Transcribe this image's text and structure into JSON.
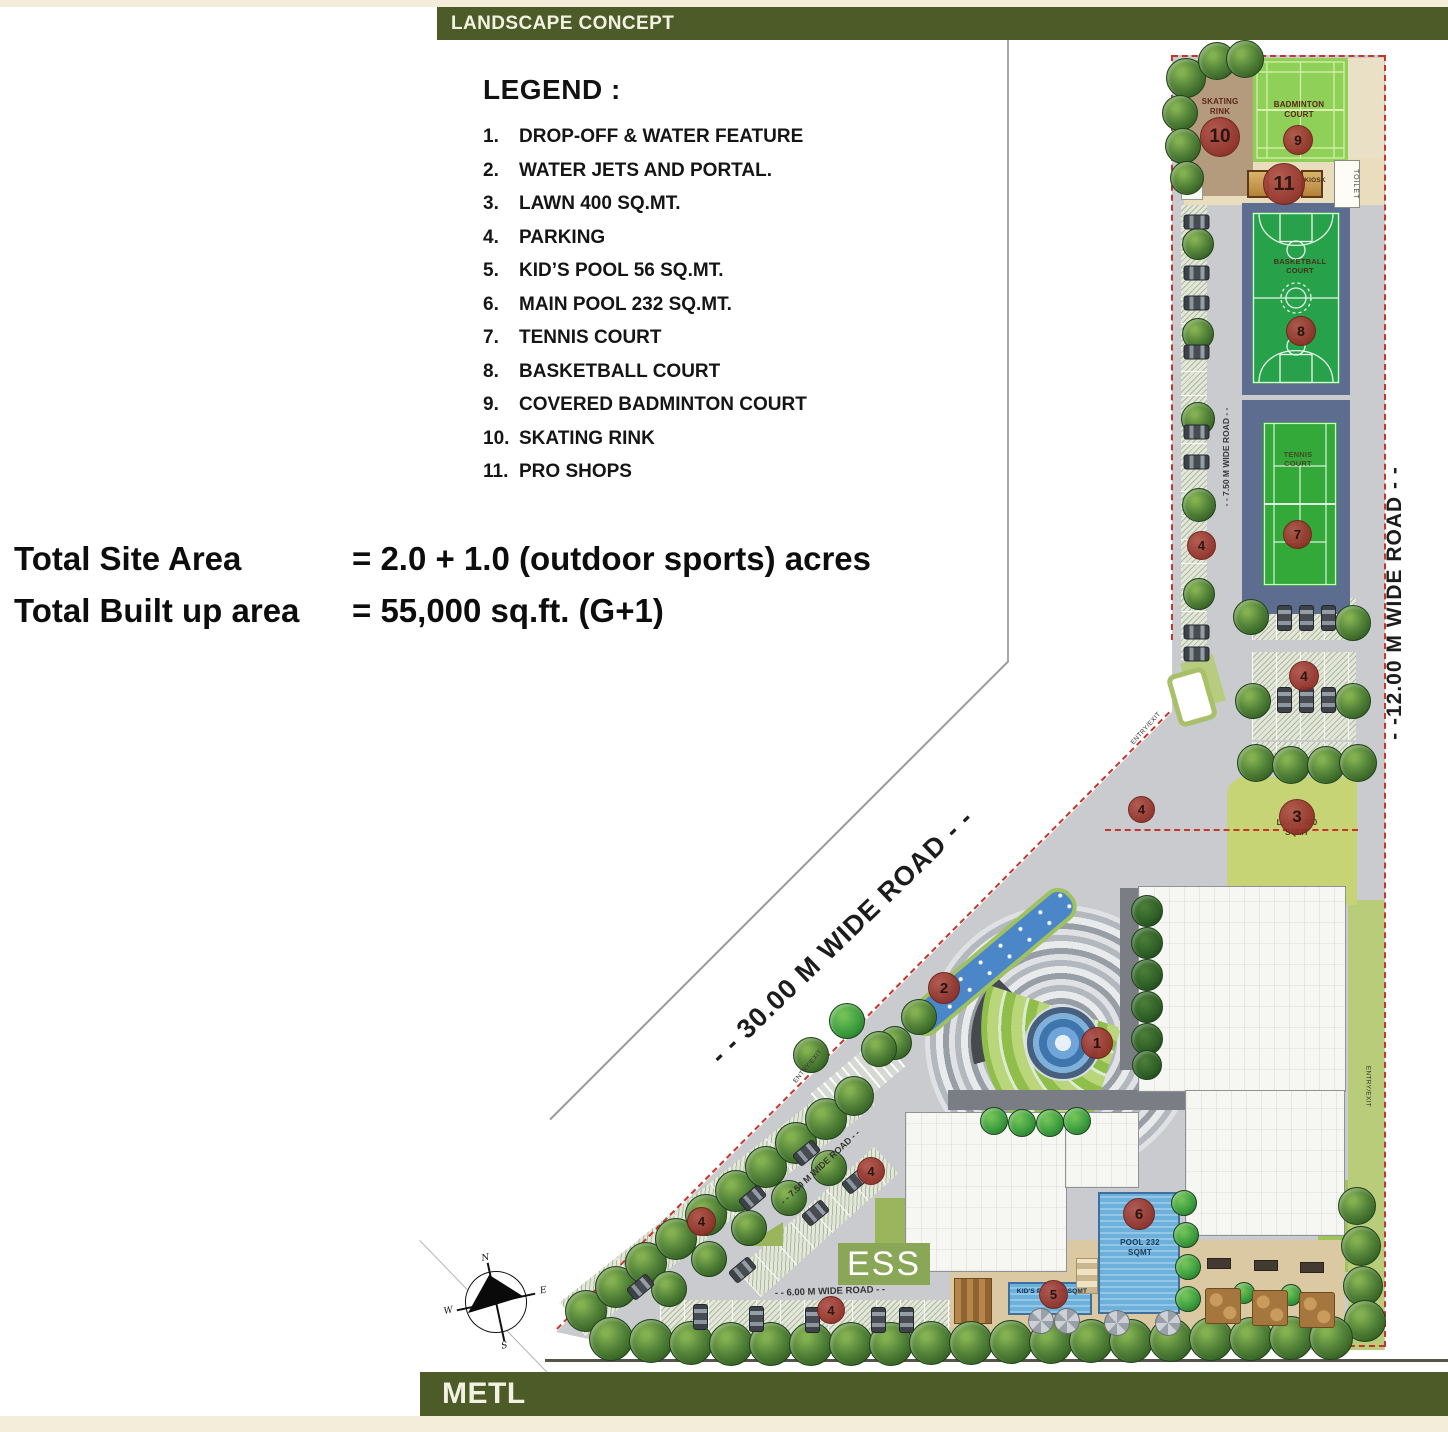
{
  "header": {
    "title": "LANDSCAPE CONCEPT"
  },
  "footer": {
    "brand": "METL"
  },
  "legend": {
    "heading": "LEGEND :",
    "items": [
      {
        "num": "1.",
        "label": "DROP-OFF & WATER FEATURE"
      },
      {
        "num": "2.",
        "label": "WATER JETS AND PORTAL."
      },
      {
        "num": "3.",
        "label": "LAWN 400 SQ.MT."
      },
      {
        "num": "4.",
        "label": "PARKING"
      },
      {
        "num": "5.",
        "label": "KID’S POOL 56 SQ.MT."
      },
      {
        "num": "6.",
        "label": "MAIN POOL 232 SQ.MT."
      },
      {
        "num": "7.",
        "label": "TENNIS COURT"
      },
      {
        "num": "8.",
        "label": "BASKETBALL COURT"
      },
      {
        "num": "9.",
        "label": "COVERED BADMINTON COURT"
      },
      {
        "num": "10.",
        "label": "SKATING RINK"
      },
      {
        "num": "11.",
        "label": "PRO SHOPS"
      }
    ]
  },
  "summary": {
    "line1_label": "Total Site Area",
    "line1_value": "= 2.0 + 1.0 (outdoor sports) acres",
    "line2_label": "Total Built up area",
    "line2_value": "= 55,000 sq.ft. (G+1)"
  },
  "roads": {
    "r30": "- - 30.00 M WIDE ROAD - -",
    "r12": "- -12.00 M WIDE ROAD - -",
    "r75_upper": "- - 7.50 M WIDE ROAD - -",
    "r75_lower": "- - 7.50 M WIDE ROAD - -",
    "r6": "- - 6.00 M WIDE ROAD - -"
  },
  "plan": {
    "labels": {
      "skating": "SKATING RINK",
      "badminton": "BADMINTON COURT",
      "basketball": "BASKETBALL COURT",
      "tennis": "TENNIS COURT",
      "lawn": "LAWN 400 SQMT",
      "pool": "POOL 232 SQMT",
      "kids_pool": "KID'S POOL 56 SQMT",
      "kiosk": "KIOSK",
      "toilet": "TOILET",
      "ess": "ESS",
      "entry_exit": "ENTRY/EXIT"
    },
    "markers": [
      {
        "num": "1"
      },
      {
        "num": "2"
      },
      {
        "num": "3"
      },
      {
        "num": "4"
      },
      {
        "num": "4"
      },
      {
        "num": "4"
      },
      {
        "num": "4"
      },
      {
        "num": "4"
      },
      {
        "num": "4"
      },
      {
        "num": "5"
      },
      {
        "num": "6"
      },
      {
        "num": "7"
      },
      {
        "num": "8"
      },
      {
        "num": "9"
      },
      {
        "num": "10"
      },
      {
        "num": "11"
      }
    ]
  },
  "compass": {
    "n": "N",
    "e": "E",
    "s": "S",
    "w": "W"
  },
  "colors": {
    "brand_bar": "#4c5b27",
    "boundary_red": "#c5362a",
    "marker_red": "#963129",
    "court_green": "#28a14b",
    "pool_blue": "#6cb0dc",
    "lawn_green": "#c6d475",
    "road_gray": "#c9cbce"
  }
}
